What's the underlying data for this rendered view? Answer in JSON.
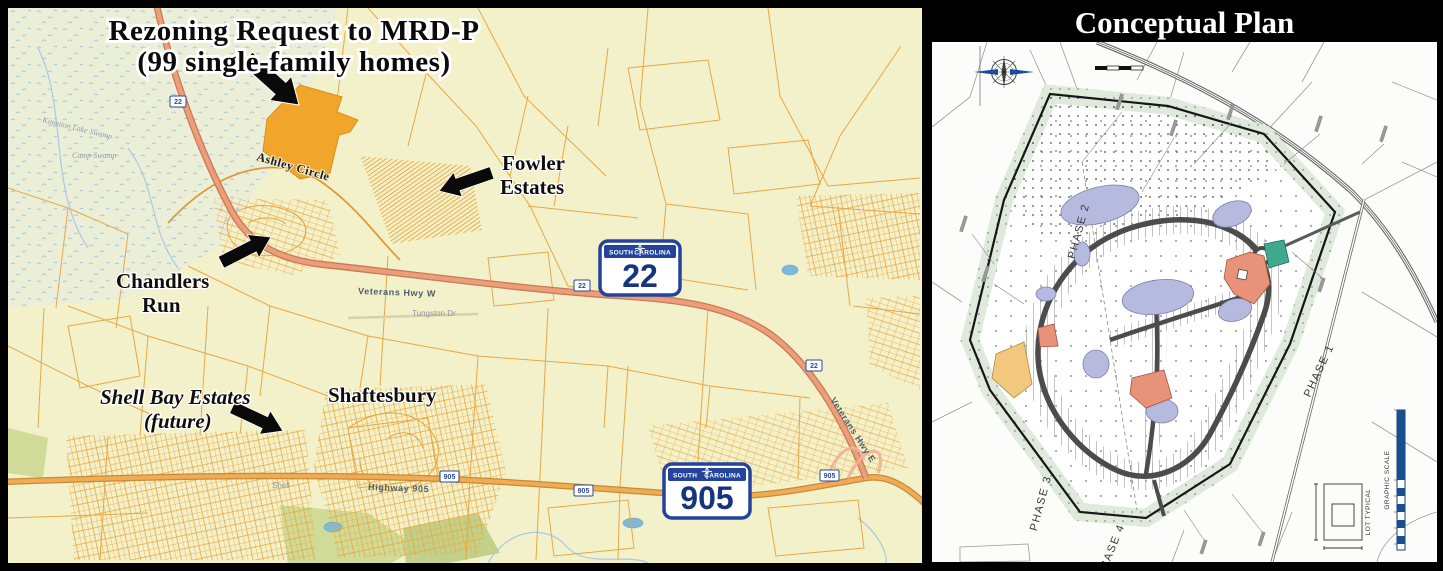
{
  "map": {
    "title1": "Rezoning Request to MRD-P",
    "title2": "(99 single-family homes)",
    "labels": {
      "ashley": "Ashley Circle",
      "fowler1": "Fowler",
      "fowler2": "Estates",
      "chandlers1": "Chandlers",
      "chandlers2": "Run",
      "shellbay1": "Shell Bay Estates",
      "shellbay2": "(future)",
      "shaftesbury": "Shaftesbury",
      "veterans_w": "Veterans Hwy W",
      "veterans_e": "Veterans Hwy E",
      "tungston": "Tungston Dr",
      "highway905": "Highway 905",
      "kingston": "Kingston Lake Swamp",
      "camp": "Camp Swamp",
      "shell": "Shell"
    },
    "shield22": {
      "top": "SOUTH",
      "right": "CAROLINA",
      "num": "22"
    },
    "shield905": {
      "top": "SOUTH",
      "right": "CAROLINA",
      "num": "905"
    },
    "marker22": "22",
    "marker905": "905"
  },
  "plan": {
    "title": "Conceptual Plan",
    "phase1": "PHASE 1",
    "phase2": "PHASE 2",
    "phase3": "PHASE 3",
    "phase4": "PHASE 4",
    "lot_typical": "LOT TYPICAL",
    "graphic_scale": "GRAPHIC SCALE"
  },
  "colors": {
    "map_bg": "#f3f1ca",
    "parcel_line": "#eca43e",
    "site_highlight": "#f2a52b",
    "highway_salmon": "#eb9e78",
    "road_905": "#f0ac55",
    "shield_blue": "#24439c",
    "pond_lavender": "#b7badf",
    "buffer_green": "#dfeadd",
    "amenity_salmon": "#e8927a",
    "amenity_teal": "#41a890",
    "amenity_tan": "#f2c77e",
    "plan_road": "#4c4c4c"
  }
}
